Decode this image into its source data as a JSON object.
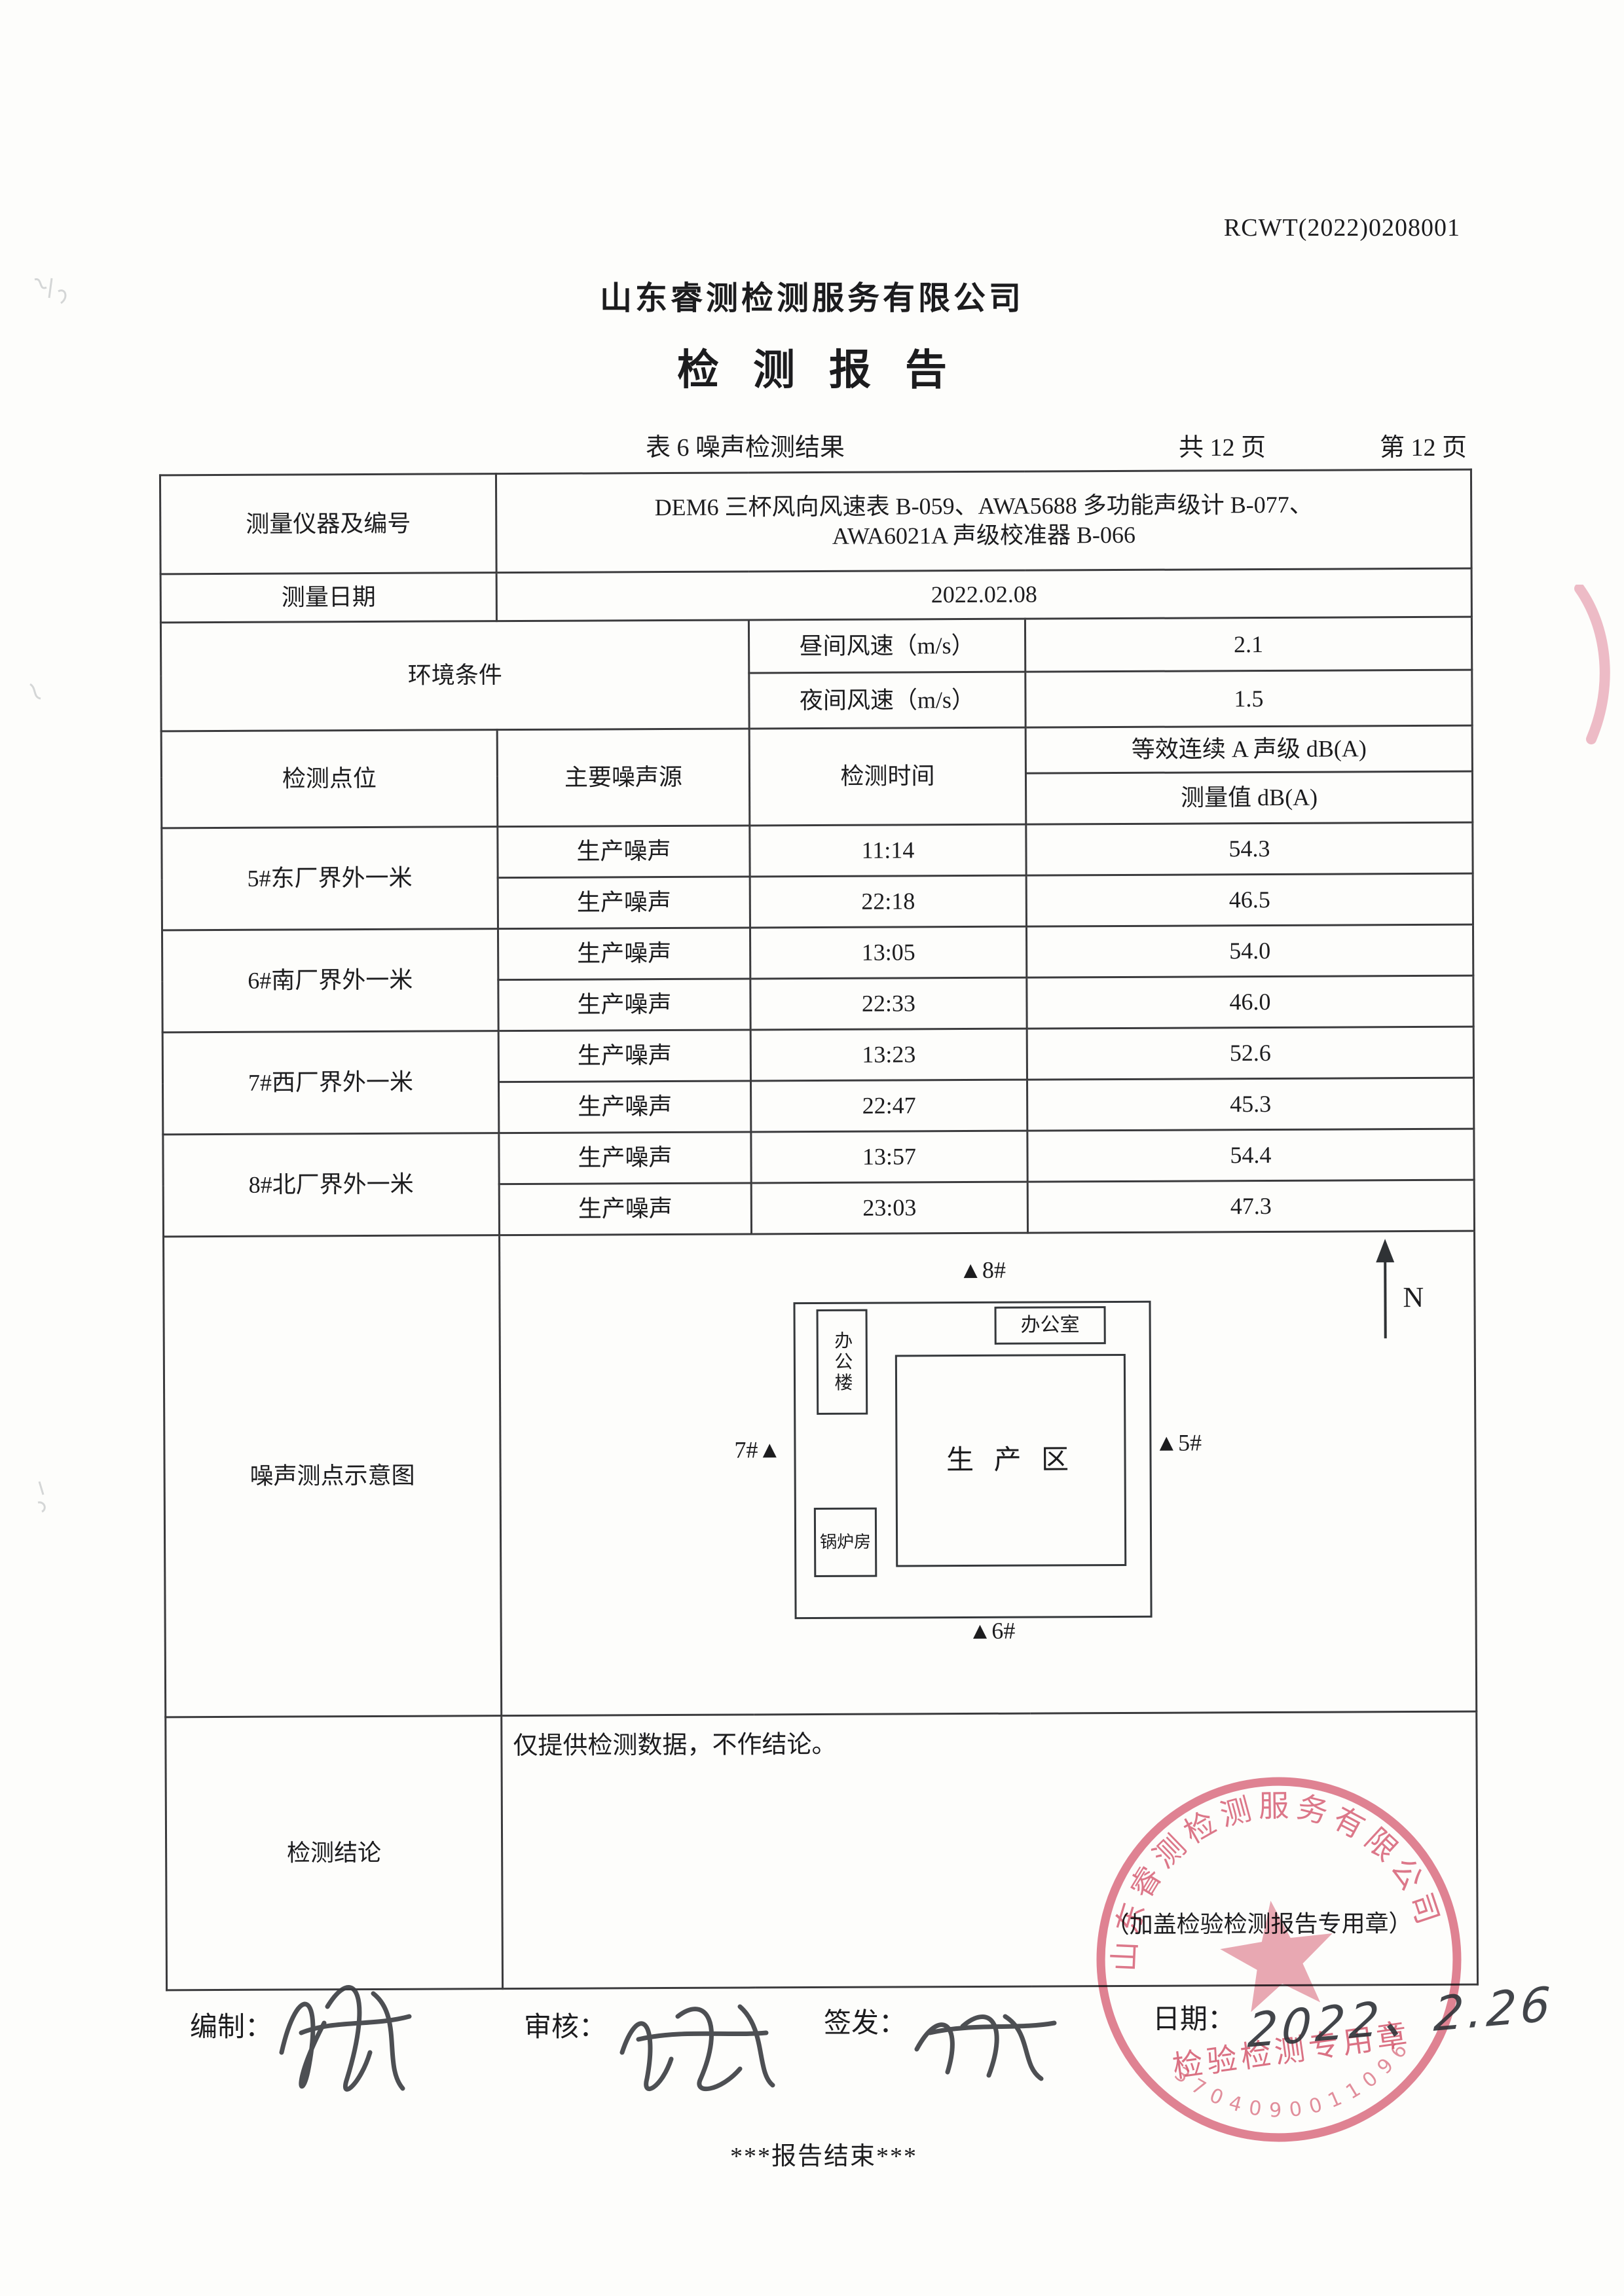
{
  "page": {
    "report_no": "RCWT(2022)0208001",
    "company": "山东睿测检测服务有限公司",
    "title": "检 测 报 告",
    "table_caption": "表 6  噪声检测结果",
    "page_total": "共 12 页",
    "page_current": "第 12 页"
  },
  "info": {
    "instrument_label": "测量仪器及编号",
    "instrument_line1": "DEM6 三杯风向风速表 B-059、AWA5688 多功能声级计 B-077、",
    "instrument_line2": "AWA6021A 声级校准器 B-066",
    "date_label": "测量日期",
    "date_value": "2022.02.08",
    "env_label": "环境条件",
    "day_wind_label": "昼间风速（m/s）",
    "day_wind_value": "2.1",
    "night_wind_label": "夜间风速（m/s）",
    "night_wind_value": "1.5"
  },
  "noise_table": {
    "headers": {
      "point": "检测点位",
      "source": "主要噪声源",
      "time": "检测时间",
      "level_group": "等效连续 A 声级 dB(A)",
      "level_sub": "测量值 dB(A)"
    },
    "groups": [
      {
        "point": "5#东厂界外一米",
        "rows": [
          {
            "source": "生产噪声",
            "time": "11:14",
            "value": "54.3"
          },
          {
            "source": "生产噪声",
            "time": "22:18",
            "value": "46.5"
          }
        ]
      },
      {
        "point": "6#南厂界外一米",
        "rows": [
          {
            "source": "生产噪声",
            "time": "13:05",
            "value": "54.0"
          },
          {
            "source": "生产噪声",
            "time": "22:33",
            "value": "46.0"
          }
        ]
      },
      {
        "point": "7#西厂界外一米",
        "rows": [
          {
            "source": "生产噪声",
            "time": "13:23",
            "value": "52.6"
          },
          {
            "source": "生产噪声",
            "time": "22:47",
            "value": "45.3"
          }
        ]
      },
      {
        "point": "8#北厂界外一米",
        "rows": [
          {
            "source": "生产噪声",
            "time": "13:57",
            "value": "54.4"
          },
          {
            "source": "生产噪声",
            "time": "23:03",
            "value": "47.3"
          }
        ]
      }
    ]
  },
  "diagram": {
    "label": "噪声测点示意图",
    "office_building": "办公楼",
    "office": "办公室",
    "production_area": "生 产 区",
    "boiler_room": "锅炉房",
    "north": "N",
    "point8": "▲8#",
    "point5": "▲5#",
    "point7": "7#▲",
    "point6": "▲6#"
  },
  "conclusion": {
    "label": "检测结论",
    "text": "仅提供检测数据，不作结论。",
    "seal_note": "（加盖检验检测报告专用章）"
  },
  "footer": {
    "prepared_label": "编制：",
    "reviewed_label": "审核：",
    "issued_label": "签发：",
    "date_label": "日期：",
    "date_value": "2022、2.26",
    "end_text": "***报告结束***"
  },
  "stamp": {
    "ring_text": "山东睿测检测服务有限公司",
    "center_text": "检验检测专用章",
    "number": "3704090011096",
    "color": "#d5536b"
  }
}
